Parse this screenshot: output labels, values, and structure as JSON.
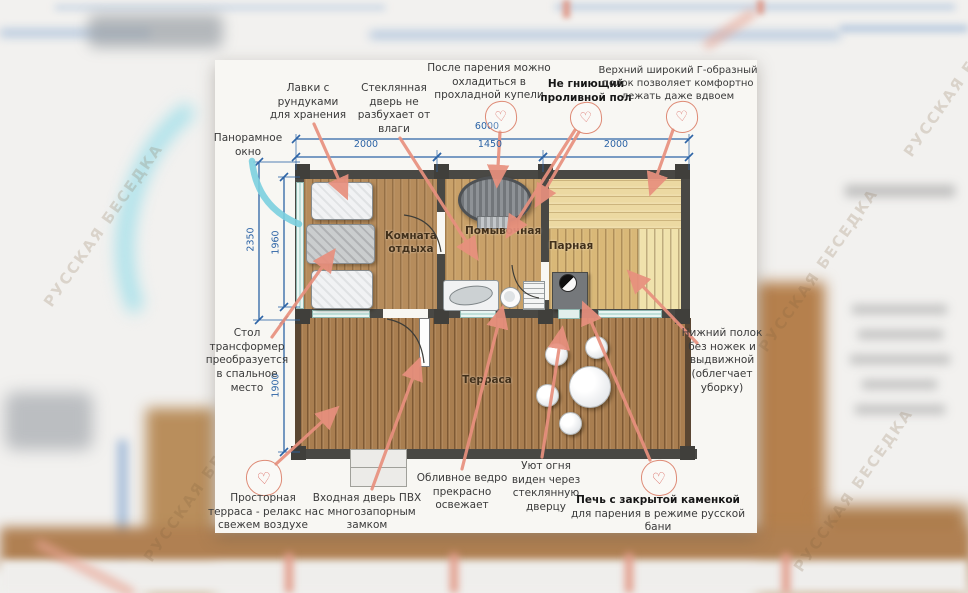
{
  "watermark": "РУССКАЯ БЕСЕДКА",
  "icons": {
    "heart": "♡"
  },
  "colors": {
    "arrow": "#e8907e",
    "heart_outline": "#de8a75",
    "heart_glyph": "#d96a62",
    "dimension_blue": "#2d64a6",
    "wall": "#494844",
    "window_teal": "#bfe0da",
    "panoramic_arc_cyan": "#7bcfdf",
    "card_paper": "#f8f7f3",
    "rest_wood": "#b68c5c",
    "wash_wood": "#c9a169",
    "steam_wood": "#d9b878",
    "steam_bench": "#ecd9a2",
    "terrace_wood": "#a97e50"
  },
  "plan": {
    "rooms": {
      "rest": "Комната отдыха",
      "wash": "Помывочная",
      "steam": "Парная",
      "terrace": "Терраса"
    }
  },
  "dimensions": {
    "total_width": "6000",
    "seg1": "2000",
    "seg2": "1450",
    "seg3": "2000",
    "left_outer": "2350",
    "left_inner": "1960",
    "terrace_depth": "1900"
  },
  "annotations": [
    {
      "id": "benches",
      "text": "Лавки с\nрундуками\nдля хранения",
      "cx": 308,
      "top": 82,
      "w": 96,
      "arrows": [
        [
          314,
          124,
          346,
          196
        ]
      ]
    },
    {
      "id": "glass-door",
      "text": "Стеклянная\nдверь не\nразбухает от\nвлаги",
      "cx": 394,
      "top": 82,
      "w": 92,
      "arrows": [
        [
          400,
          138,
          476,
          257
        ]
      ]
    },
    {
      "id": "cool-tub",
      "text": "После парения можно\nохладиться в\nпрохладной купели",
      "cx": 489,
      "top": 62,
      "w": 140,
      "heart": {
        "cx": 500,
        "cy": 116,
        "r": 15
      },
      "arrows": [
        [
          500,
          132,
          497,
          184
        ]
      ]
    },
    {
      "id": "drain-floor",
      "text": "Не гниющий\nпроливной пол",
      "cx": 586,
      "top": 78,
      "w": 104,
      "bold": true,
      "heart": {
        "cx": 585,
        "cy": 117,
        "r": 15
      },
      "arrows": [
        [
          579,
          132,
          537,
          204
        ],
        [
          575,
          130,
          508,
          235
        ]
      ]
    },
    {
      "id": "upper-shelf",
      "text": "Верхний широкий Г-образный\nполок позволяет комфортно\nлежать даже вдвоем",
      "cx": 678,
      "top": 64,
      "w": 160,
      "fs": 10,
      "heart": {
        "cx": 681,
        "cy": 116,
        "r": 15
      },
      "arrows": [
        [
          673,
          130,
          651,
          192
        ]
      ]
    },
    {
      "id": "panoramic-window",
      "text": "Панорамное\nокно",
      "cx": 248,
      "top": 132,
      "w": 84,
      "arrows": []
    },
    {
      "id": "transformer-table",
      "text": "Стол\nтрансформер\nпреобразуется\nв спальное\nместо",
      "cx": 247,
      "top": 327,
      "w": 92,
      "arrows": [
        [
          272,
          337,
          333,
          252
        ]
      ]
    },
    {
      "id": "lower-shelf",
      "text": "Нижний полок\nбез ножек и\nвыдвижной\n(облегчает\nуборку)",
      "cx": 722,
      "top": 327,
      "w": 92,
      "arrows": [
        [
          697,
          343,
          630,
          273
        ]
      ]
    },
    {
      "id": "terrace-note",
      "text": "Просторная\nтерраса - релакс на\nсвежем воздухе",
      "cx": 263,
      "top": 492,
      "w": 118,
      "heart": {
        "cx": 263,
        "cy": 477,
        "r": 17
      },
      "arrows": [
        [
          276,
          464,
          336,
          409
        ]
      ]
    },
    {
      "id": "entrance-door",
      "text": "Входная дверь ПВХ\nс многозапорным\nзамком",
      "cx": 367,
      "top": 492,
      "w": 124,
      "arrows": [
        [
          372,
          489,
          419,
          361
        ]
      ]
    },
    {
      "id": "bucket",
      "text": "Обливное ведро\nпрекрасно\nосвежает",
      "cx": 462,
      "top": 472,
      "w": 104,
      "arrows": [
        [
          462,
          469,
          502,
          309
        ]
      ]
    },
    {
      "id": "fire-view",
      "text": "Уют огня\nвиден через\nстеклянную\nдверцу",
      "cx": 546,
      "top": 460,
      "w": 86,
      "arrows": [
        [
          542,
          457,
          562,
          330
        ]
      ]
    },
    {
      "id": "stove-note",
      "parts": [
        {
          "t": "Печь  с закрытой каменкой",
          "b": true
        },
        {
          "t": " для парения в режиме русской бани",
          "b": false
        }
      ],
      "cx": 658,
      "top": 494,
      "w": 180,
      "heart": {
        "cx": 658,
        "cy": 477,
        "r": 17
      },
      "arrows": [
        [
          650,
          460,
          584,
          305
        ]
      ]
    }
  ]
}
